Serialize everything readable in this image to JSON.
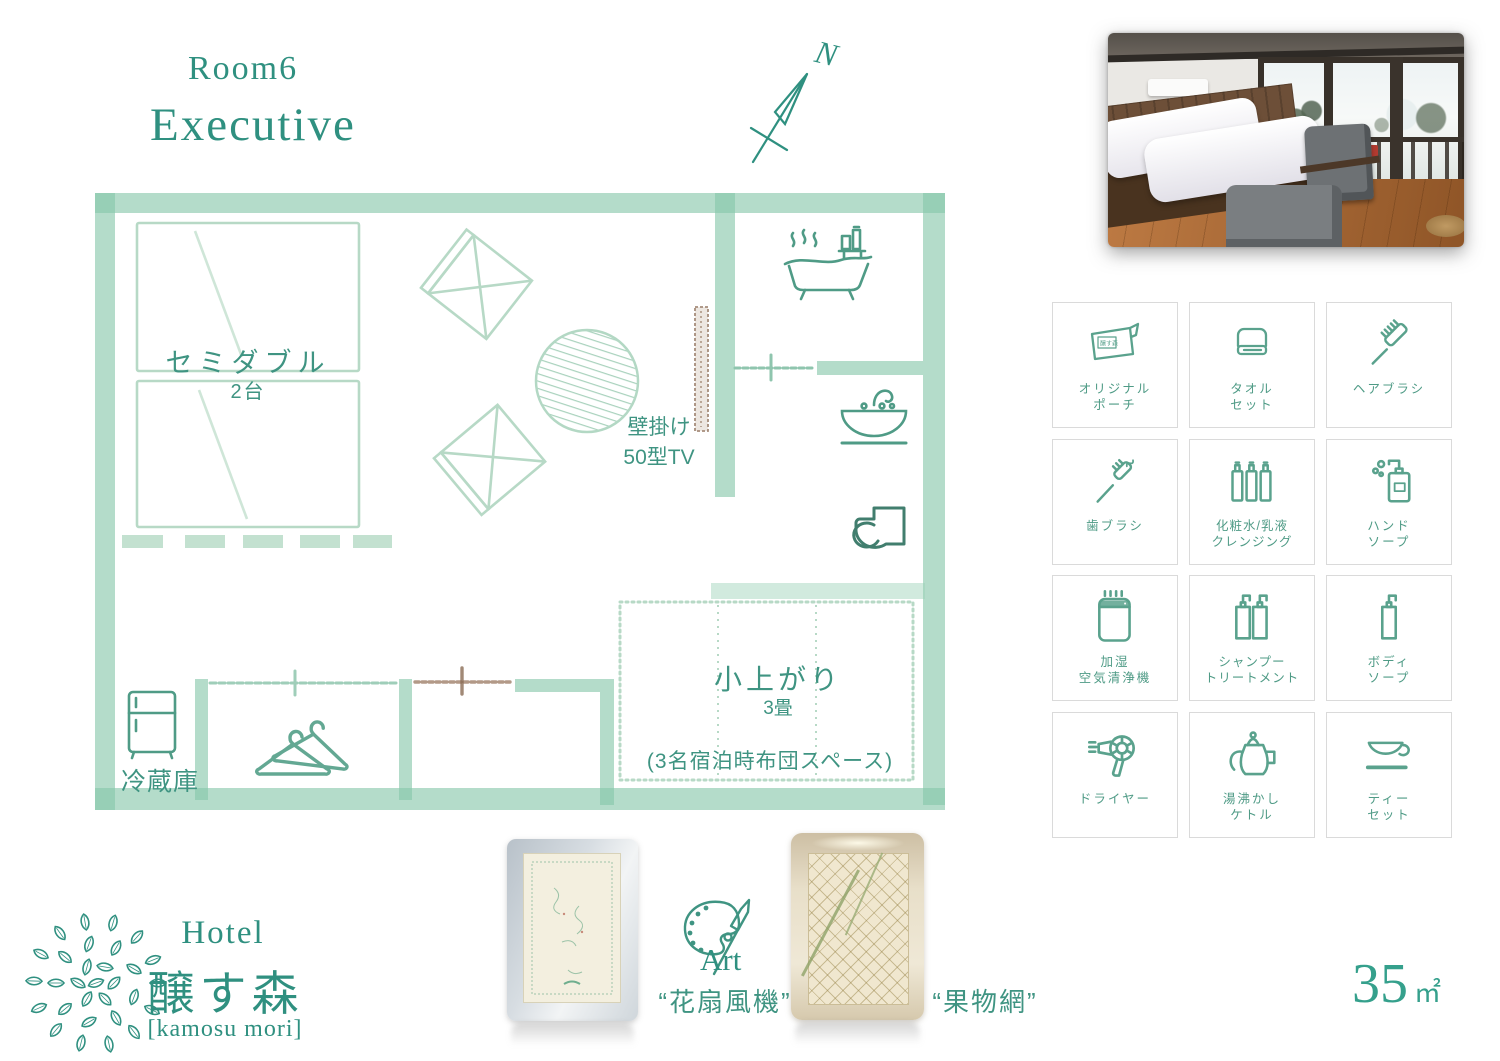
{
  "header": {
    "room_number": "Room6",
    "room_type": "Executive"
  },
  "compass": {
    "north_label": "N"
  },
  "floor_plan": {
    "bed_type": "セミダブル",
    "bed_count": "2台",
    "tv_line1": "壁掛け",
    "tv_line2": "50型TV",
    "tatami_name": "小上がり",
    "tatami_size": "3畳",
    "tatami_note": "(3名宿泊時布団スペース)",
    "fridge_label": "冷蔵庫"
  },
  "amenities": [
    {
      "line1": "オリジナル",
      "line2": "ポーチ",
      "badge": "醸す森"
    },
    {
      "line1": "タオル",
      "line2": "セット"
    },
    {
      "line1": "ヘアブラシ",
      "line2": ""
    },
    {
      "line1": "歯ブラシ",
      "line2": ""
    },
    {
      "line1": "化粧水/乳液",
      "line2": "クレンジング"
    },
    {
      "line1": "ハンド",
      "line2": "ソープ"
    },
    {
      "line1": "加湿",
      "line2": "空気清浄機"
    },
    {
      "line1": "シャンプー",
      "line2": "トリートメント"
    },
    {
      "line1": "ボディ",
      "line2": "ソープ"
    },
    {
      "line1": "ドライヤー",
      "line2": ""
    },
    {
      "line1": "湯沸かし",
      "line2": "ケトル"
    },
    {
      "line1": "ティー",
      "line2": "セット"
    }
  ],
  "hotel": {
    "name_en": "Hotel",
    "name_jp": "醸す森",
    "name_romaji": "[kamosu mori]"
  },
  "art": {
    "label": "Art",
    "left_title": "“花扇風機”",
    "right_title": "“果物網”"
  },
  "area": {
    "value": "35",
    "unit": "㎡"
  },
  "colors": {
    "accent": "#2f9080",
    "wall_green": "#86c6a9",
    "icon_teal": "#4f9b86",
    "tv_brown": "#a68d7b"
  }
}
